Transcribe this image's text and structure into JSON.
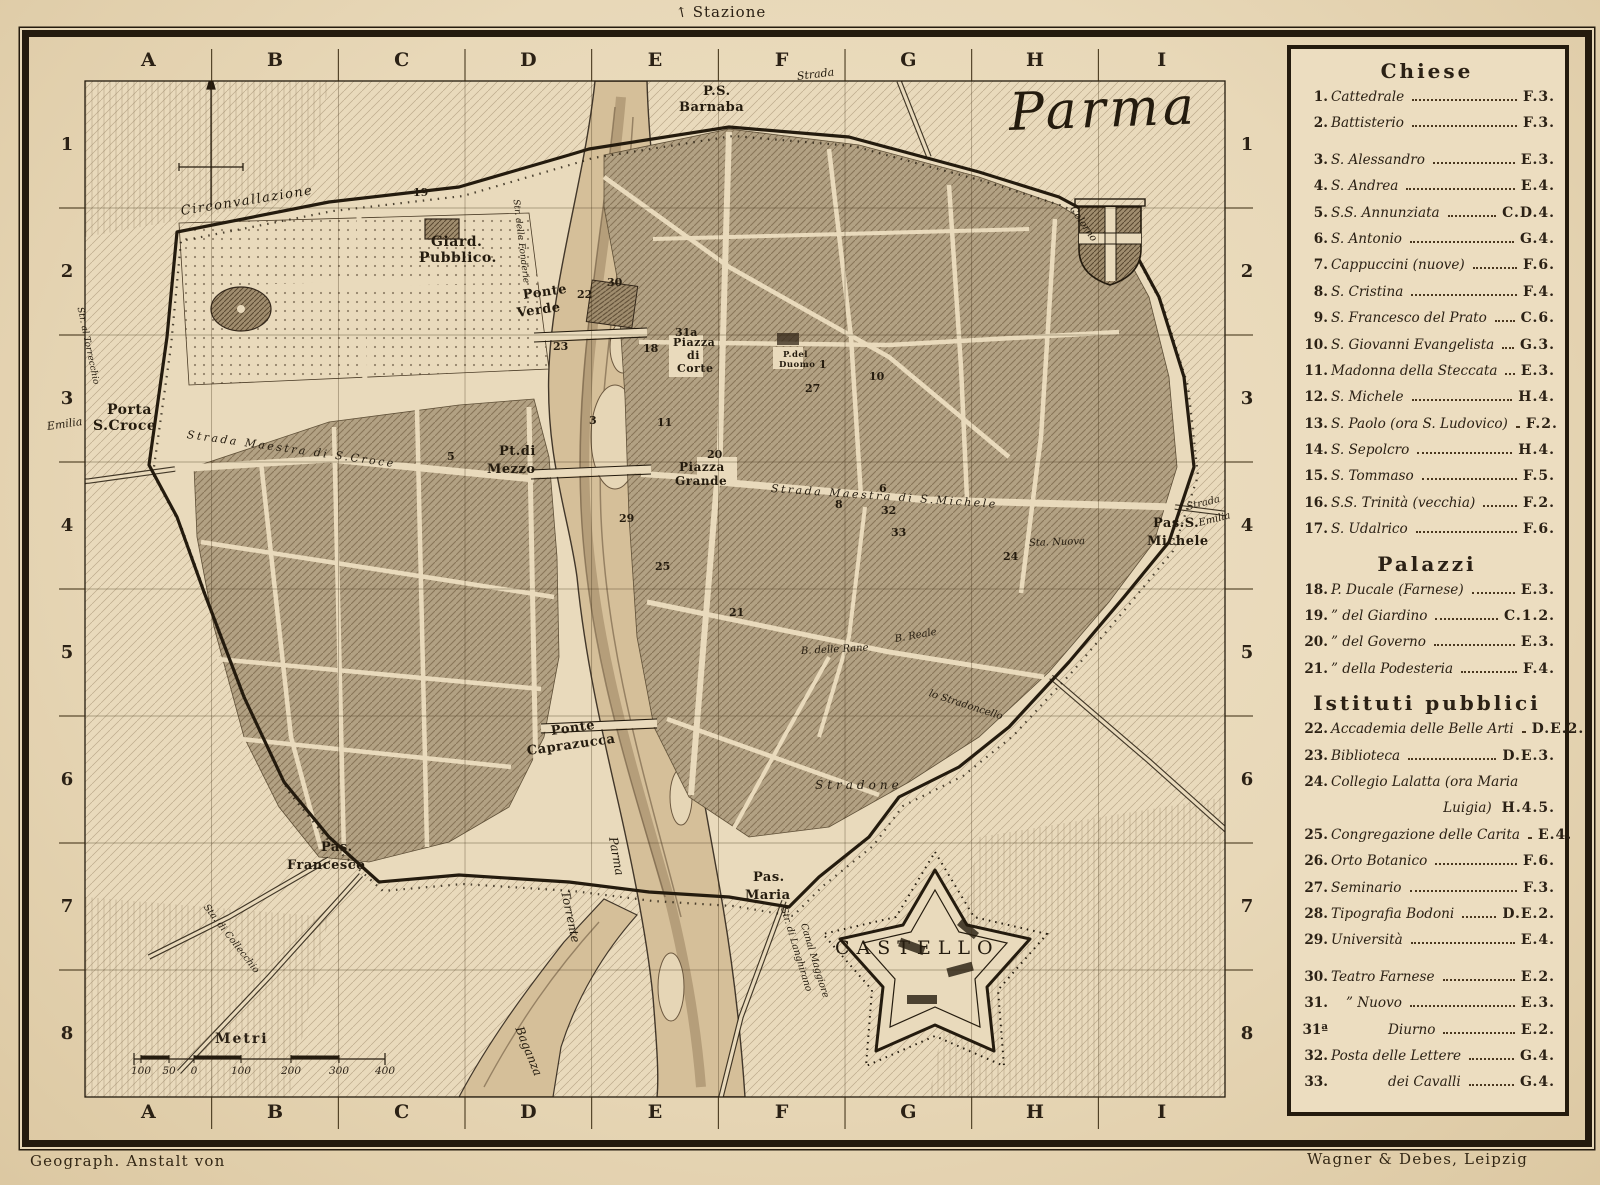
{
  "page": {
    "station": "Stazione",
    "credit_left": "Geograph. Anstalt von",
    "credit_right": "Wagner & Debes, Leipzig"
  },
  "colors": {
    "paper": "#e9dabc",
    "ink": "#241b0e",
    "city_block": "#b2a183",
    "river": "#d5bf99",
    "legend_bg": "#ecddc0"
  },
  "map": {
    "title": "Parma",
    "grid": {
      "columns": [
        "A",
        "B",
        "C",
        "D",
        "E",
        "F",
        "G",
        "H",
        "I"
      ],
      "rows": [
        "1",
        "2",
        "3",
        "4",
        "5",
        "6",
        "7",
        "8"
      ]
    },
    "scale_bar": {
      "label": "Metri",
      "ticks": [
        {
          "t": "100",
          "x": 112
        },
        {
          "t": "50",
          "x": 140
        },
        {
          "t": "0",
          "x": 165
        },
        {
          "t": "100",
          "x": 212
        },
        {
          "t": "200",
          "x": 262
        },
        {
          "t": "300",
          "x": 310
        },
        {
          "t": "400",
          "x": 356
        }
      ]
    },
    "labels": [
      {
        "t": "Parma",
        "x": 980,
        "y": 50,
        "s": 52,
        "c": "scr"
      },
      {
        "t": "Circonvallazione",
        "x": 152,
        "y": 168,
        "s": 13,
        "r": -9,
        "c": "it sp1"
      },
      {
        "t": "Giard.",
        "x": 402,
        "y": 198,
        "s": 14,
        "c": "bd"
      },
      {
        "t": "Pubblico.",
        "x": 390,
        "y": 214,
        "s": 14,
        "c": "bd"
      },
      {
        "t": "Porta",
        "x": 78,
        "y": 366,
        "s": 14,
        "c": "bd"
      },
      {
        "t": "S.Croce",
        "x": 64,
        "y": 382,
        "s": 14,
        "c": "bd"
      },
      {
        "t": "Emilia",
        "x": 18,
        "y": 384,
        "s": 11,
        "r": -8,
        "c": "it"
      },
      {
        "t": "Strada Maestra di S.Croce",
        "x": 158,
        "y": 392,
        "s": 11,
        "r": 8,
        "c": "it sp2"
      },
      {
        "t": "Ponte",
        "x": 494,
        "y": 252,
        "s": 13,
        "r": -8,
        "c": "bd"
      },
      {
        "t": "Verde",
        "x": 488,
        "y": 270,
        "s": 13,
        "r": -8,
        "c": "bd"
      },
      {
        "t": "Pt.di",
        "x": 470,
        "y": 408,
        "s": 13,
        "c": "bd"
      },
      {
        "t": "Mezzo",
        "x": 458,
        "y": 426,
        "s": 13,
        "c": "bd"
      },
      {
        "t": "Ponte",
        "x": 522,
        "y": 688,
        "s": 13,
        "r": -8,
        "c": "bd"
      },
      {
        "t": "Caprazucca",
        "x": 498,
        "y": 708,
        "s": 13,
        "r": -8,
        "c": "bd"
      },
      {
        "t": "P.S.",
        "x": 674,
        "y": 48,
        "s": 13,
        "c": "bd"
      },
      {
        "t": "Barnaba",
        "x": 650,
        "y": 64,
        "s": 13,
        "c": "bd"
      },
      {
        "t": "Strada",
        "x": 768,
        "y": 34,
        "s": 11,
        "r": -7,
        "c": "it"
      },
      {
        "t": "Str. delle Fonderie",
        "x": 486,
        "y": 158,
        "s": 9,
        "r": 83,
        "c": "it"
      },
      {
        "t": "Colorno",
        "x": 1042,
        "y": 166,
        "s": 10,
        "r": 55,
        "c": "it"
      },
      {
        "t": "Pas.S.",
        "x": 1124,
        "y": 480,
        "s": 13,
        "c": "bd"
      },
      {
        "t": "Michele",
        "x": 1118,
        "y": 498,
        "s": 13,
        "c": "bd"
      },
      {
        "t": "Strada",
        "x": 1158,
        "y": 466,
        "s": 10,
        "r": -14,
        "c": "it"
      },
      {
        "t": "Emilia",
        "x": 1170,
        "y": 482,
        "s": 10,
        "r": -14,
        "c": "it"
      },
      {
        "t": "Strada Maestra di S.Michele",
        "x": 742,
        "y": 446,
        "s": 11,
        "r": 4,
        "c": "it sp2"
      },
      {
        "t": "Piazza",
        "x": 650,
        "y": 424,
        "s": 12,
        "c": "bd"
      },
      {
        "t": "Grande",
        "x": 646,
        "y": 438,
        "s": 12,
        "c": "bd"
      },
      {
        "t": "Piazza",
        "x": 644,
        "y": 300,
        "s": 11,
        "c": "bd"
      },
      {
        "t": "di",
        "x": 658,
        "y": 313,
        "s": 11,
        "c": "bd"
      },
      {
        "t": "Corte",
        "x": 648,
        "y": 326,
        "s": 11,
        "c": "bd"
      },
      {
        "t": "P.del",
        "x": 754,
        "y": 314,
        "s": 8.5,
        "c": "bd"
      },
      {
        "t": "Duomo",
        "x": 750,
        "y": 324,
        "s": 8.5,
        "c": "bd"
      },
      {
        "t": "Stradone",
        "x": 786,
        "y": 742,
        "s": 12,
        "c": "it sp3"
      },
      {
        "t": "lo Stradoncello",
        "x": 900,
        "y": 652,
        "s": 10,
        "r": 18,
        "c": "it"
      },
      {
        "t": "B. delle Rane",
        "x": 772,
        "y": 610,
        "s": 10,
        "r": -3,
        "c": "it"
      },
      {
        "t": "B. Reale",
        "x": 866,
        "y": 598,
        "s": 10,
        "r": -10,
        "c": "it"
      },
      {
        "t": "Sta. Nuova",
        "x": 1000,
        "y": 502,
        "s": 10,
        "r": -2,
        "c": "it"
      },
      {
        "t": "CASTELLO",
        "x": 806,
        "y": 902,
        "s": 19,
        "c": "cap"
      },
      {
        "t": "Pas.",
        "x": 724,
        "y": 834,
        "s": 13,
        "c": "bd"
      },
      {
        "t": "Maria",
        "x": 716,
        "y": 852,
        "s": 13,
        "c": "bd"
      },
      {
        "t": "Pas.",
        "x": 292,
        "y": 804,
        "s": 13,
        "c": "bd"
      },
      {
        "t": "Francesco",
        "x": 258,
        "y": 822,
        "s": 13,
        "c": "bd"
      },
      {
        "t": "Torrente",
        "x": 536,
        "y": 848,
        "s": 12,
        "r": 78,
        "c": "it"
      },
      {
        "t": "Parma",
        "x": 584,
        "y": 794,
        "s": 12,
        "r": 80,
        "c": "it"
      },
      {
        "t": "Baganza",
        "x": 490,
        "y": 984,
        "s": 12,
        "r": 68,
        "c": "it"
      },
      {
        "t": "Str. di Langhirano",
        "x": 754,
        "y": 866,
        "s": 9.5,
        "r": 73,
        "c": "it"
      },
      {
        "t": "Canal Maggiore",
        "x": 774,
        "y": 882,
        "s": 9.5,
        "r": 73,
        "c": "it"
      },
      {
        "t": "Str. al Torrecchio",
        "x": 50,
        "y": 266,
        "s": 9,
        "r": 78,
        "c": "it"
      },
      {
        "t": "Sta. di Collecchio",
        "x": 176,
        "y": 864,
        "s": 9.5,
        "r": 52,
        "c": "it"
      }
    ],
    "numbers": [
      {
        "t": "30",
        "x": 578,
        "y": 240
      },
      {
        "t": "22",
        "x": 548,
        "y": 252
      },
      {
        "t": "23",
        "x": 524,
        "y": 304
      },
      {
        "t": "18",
        "x": 614,
        "y": 306
      },
      {
        "t": "31a",
        "x": 646,
        "y": 290
      },
      {
        "t": "20",
        "x": 678,
        "y": 412
      },
      {
        "t": "29",
        "x": 590,
        "y": 476
      },
      {
        "t": "25",
        "x": 626,
        "y": 524
      },
      {
        "t": "10",
        "x": 840,
        "y": 334
      },
      {
        "t": "1",
        "x": 790,
        "y": 322
      },
      {
        "t": "27",
        "x": 776,
        "y": 346
      },
      {
        "t": "8",
        "x": 806,
        "y": 462
      },
      {
        "t": "6",
        "x": 850,
        "y": 446
      },
      {
        "t": "32",
        "x": 852,
        "y": 468
      },
      {
        "t": "33",
        "x": 862,
        "y": 490
      },
      {
        "t": "24",
        "x": 974,
        "y": 514
      },
      {
        "t": "19",
        "x": 384,
        "y": 150
      },
      {
        "t": "5",
        "x": 418,
        "y": 414
      },
      {
        "t": "3",
        "x": 560,
        "y": 378
      },
      {
        "t": "11",
        "x": 628,
        "y": 380
      },
      {
        "t": "21",
        "x": 700,
        "y": 570
      }
    ]
  },
  "legend": {
    "sections": [
      {
        "title": "Chiese",
        "items": [
          {
            "n": "1.",
            "name": "Cattedrale",
            "ref": "F.3."
          },
          {
            "n": "2.",
            "name": "Battisterio",
            "ref": "F.3."
          },
          {
            "n": "3.",
            "name": "S. Alessandro",
            "ref": "E.3.",
            "gap": true
          },
          {
            "n": "4.",
            "name": "S. Andrea",
            "ref": "E.4."
          },
          {
            "n": "5.",
            "name": "S.S. Annunziata",
            "ref": "C.D.4."
          },
          {
            "n": "6.",
            "name": "S. Antonio",
            "ref": "G.4."
          },
          {
            "n": "7.",
            "name": "Cappuccini (nuove)",
            "ref": "F.6."
          },
          {
            "n": "8.",
            "name": "S. Cristina",
            "ref": "F.4."
          },
          {
            "n": "9.",
            "name": "S. Francesco del Prato",
            "ref": "C.6."
          },
          {
            "n": "10.",
            "name": "S. Giovanni Evangelista",
            "ref": "G.3."
          },
          {
            "n": "11.",
            "name": "Madonna della Steccata",
            "ref": "E.3."
          },
          {
            "n": "12.",
            "name": "S. Michele",
            "ref": "H.4."
          },
          {
            "n": "13.",
            "name": "S. Paolo (ora S. Ludovico)",
            "ref": "F.2."
          },
          {
            "n": "14.",
            "name": "S. Sepolcro",
            "ref": "H.4."
          },
          {
            "n": "15.",
            "name": "S. Tommaso",
            "ref": "F.5."
          },
          {
            "n": "16.",
            "name": "S.S. Trinità (vecchia)",
            "ref": "F.2."
          },
          {
            "n": "17.",
            "name": "S. Udalrico",
            "ref": "F.6."
          }
        ]
      },
      {
        "title": "Palazzi",
        "items": [
          {
            "n": "18.",
            "name": "P. Ducale (Farnese)",
            "ref": "E.3."
          },
          {
            "n": "19.",
            "name": "” del Giardino",
            "ref": "C.1.2."
          },
          {
            "n": "20.",
            "name": "” del Governo",
            "ref": "E.3."
          },
          {
            "n": "21.",
            "name": "” della Podesteria",
            "ref": "F.4."
          }
        ]
      },
      {
        "title": "Istituti pubblici",
        "items": [
          {
            "n": "22.",
            "name": "Accademia delle Belle Arti",
            "ref": "D.E.2."
          },
          {
            "n": "23.",
            "name": "Biblioteca",
            "ref": "D.E.3."
          },
          {
            "n": "24.",
            "name": "Collegio Lalatta  (ora Maria",
            "ref": ""
          },
          {
            "n": "",
            "name": "Luigia)",
            "ref": "H.4.5.",
            "cont": true
          },
          {
            "n": "25.",
            "name": "Congregazione delle Carita",
            "ref": "E.4."
          },
          {
            "n": "26.",
            "name": "Orto Botanico",
            "ref": "F.6."
          },
          {
            "n": "27.",
            "name": "Seminario",
            "ref": "F.3."
          },
          {
            "n": "28.",
            "name": "Tipografia Bodoni",
            "ref": "D.E.2."
          },
          {
            "n": "29.",
            "name": "Università",
            "ref": "E.4."
          },
          {
            "n": "30.",
            "name": "Teatro Farnese",
            "ref": "E.2.",
            "gap": true
          },
          {
            "n": "31.",
            "name": "” Nuovo",
            "ref": "E.3.",
            "ind": 1
          },
          {
            "n": "31ª",
            "name": "Diurno",
            "ref": "E.2.",
            "ind": 2
          },
          {
            "n": "32.",
            "name": "Posta delle Lettere",
            "ref": "G.4."
          },
          {
            "n": "33.",
            "name": "dei Cavalli",
            "ref": "G.4.",
            "ind": 2
          }
        ]
      }
    ]
  }
}
